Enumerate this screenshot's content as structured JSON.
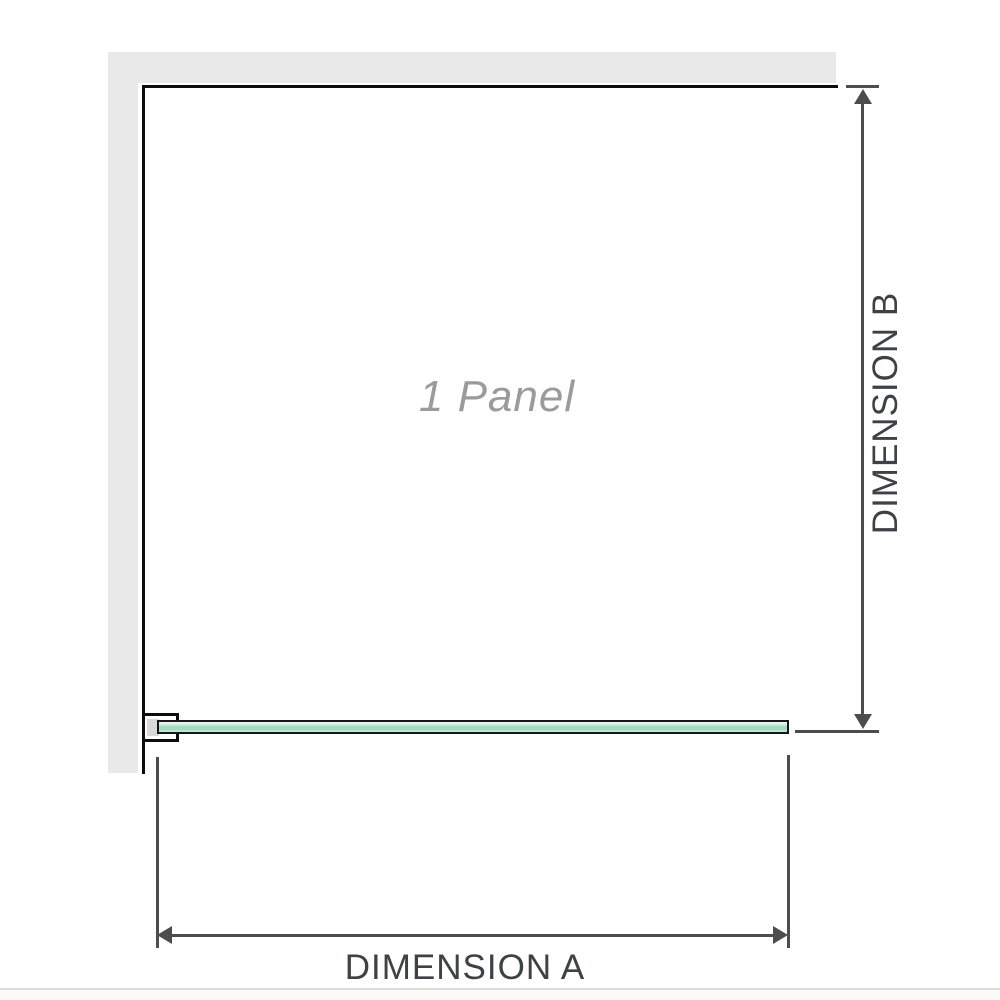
{
  "diagram": {
    "panel_label": "1 Panel",
    "dimension_a": {
      "label": "DIMENSION A"
    },
    "dimension_b": {
      "label": "DIMENSION B"
    }
  },
  "colors": {
    "wall": "#e9e9e9",
    "outline": "#0d0d0d",
    "dimension": "#4d4d4d",
    "dim_text": "#3e4145",
    "panel_label": "#9b9b9b",
    "glass_hi": "#edf8f2",
    "glass_light": "#cdecdc",
    "glass_mid": "#9cd8bc",
    "glass_mid2": "#a8dec4",
    "glass_light2": "#cfeedd",
    "divider": "#dbdbdb"
  }
}
